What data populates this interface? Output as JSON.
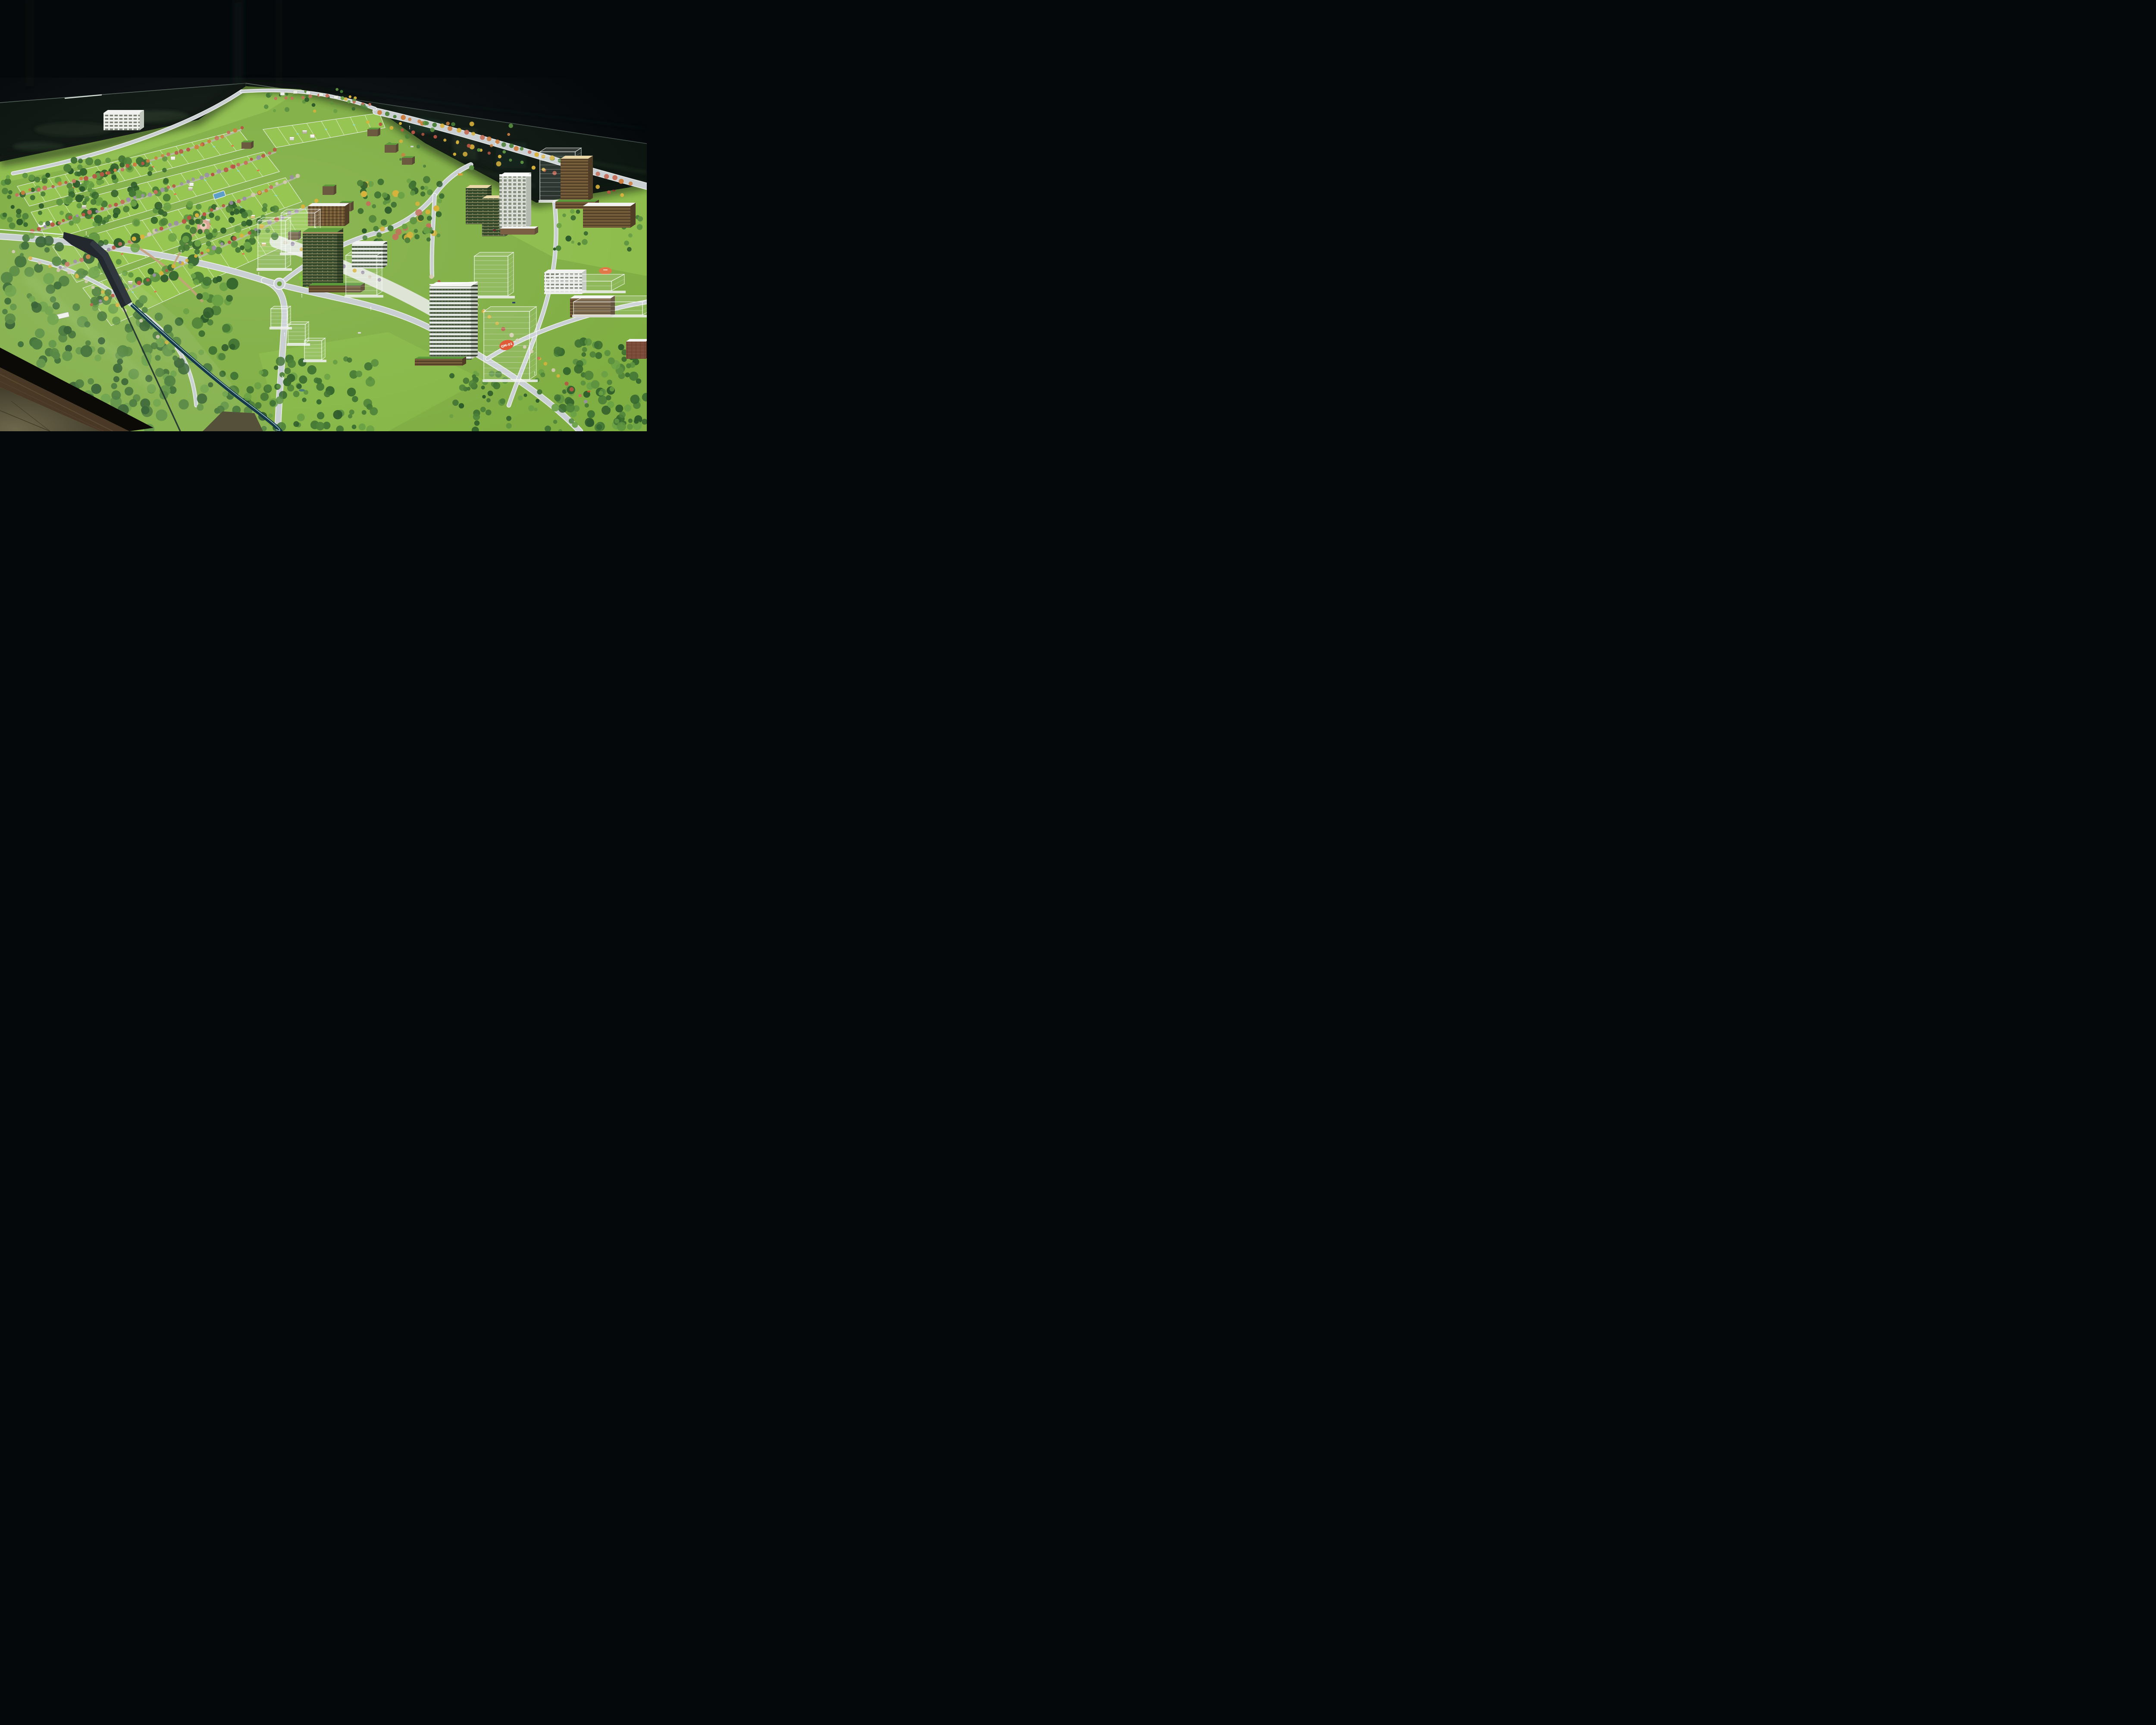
{
  "meta": {
    "title": "Photograph of an architectural scale model of a green township masterplan, displayed inside a glass-walled case on a wooden exhibition table against a black curtain backdrop"
  },
  "labels": {
    "qm_sticker": "QM-01"
  },
  "scene": {
    "environment": {
      "backdrop": "black exhibition curtain",
      "display_case": "low glass enclosure around the model with dark corner bracket",
      "table": "dark wooden model table",
      "floor": "dim tiled showroom floor in bottom-left corner"
    },
    "model_features": [
      "plotted residential parcels in curved rows with white boundary lines",
      "teal oval plot-number markers and orange sold markers",
      "rows of red, orange and yellow flowering trees along roads",
      "dense dark-green forest groves",
      "green living-facade residential towers with tan and grass roofs",
      "white high-rise tower with window grid",
      "transparent acrylic massing towers (future phases), one with orange QM-01 sticker",
      "balcony tower with planted white facade",
      "brown timber mid-rise blocks with white roofs",
      "swimming pool, round plaza, roundabout, helipad",
      "curving gray roads with white curbs, tiny cars and a yellow bus",
      "white signboards on lawns"
    ]
  },
  "palette": {
    "backdrop": "#04080a",
    "curtain_fold": "#0b1413",
    "glass_pane": "#0a130e",
    "glass_edge": "#cfe0d5",
    "glass_edge_dim": "#7e948a",
    "front_band": "#15394a",
    "front_band_hi": "#bfe0d6",
    "lawn": "#7fae42",
    "lawn_bright": "#8cbc4a",
    "plot_grass": "#98c754",
    "forest1": "#2d5a2b",
    "forest2": "#36682f",
    "forest3": "#417434",
    "forest4": "#4d8139",
    "forest5": "#5b9140",
    "forest6": "#6aa145",
    "bush_bright": "#83c93f",
    "road": "#c9cfd2",
    "curb": "#f0f2f1",
    "path_tan": "#c7a07b",
    "plaza_pink": "#d9a795",
    "plaza_pink_in": "#e9c9b8",
    "pool_blue": "#5d9ec9",
    "tree_red": "#b75643",
    "tree_red2": "#c4705c",
    "tree_orange": "#cc7f3f",
    "tree_yellow": "#d9b23c",
    "tree_pale": "#d6cbb4",
    "tree_purple": "#9a8fa6",
    "tower_green": "#3b512f",
    "tower_green_dark": "#2c4125",
    "roof_tan": "#ead7a8",
    "roof_white": "#f2f3f0",
    "roof_grass": "#5d9a3c",
    "tower_white": "#e9ebe7",
    "slat_brown": "#6b5434",
    "brick": "#7a4a38",
    "sticker_orange": "#e05a38",
    "marker_teal": "#8fd8cc",
    "marker_orange": "#e07848",
    "wood": "#4a3826",
    "wood_grain": "#6e5639",
    "base_black": "#0c0a07",
    "floor": "#55503a",
    "floor_light": "#6d674c",
    "floor_joint": "#35311f"
  }
}
